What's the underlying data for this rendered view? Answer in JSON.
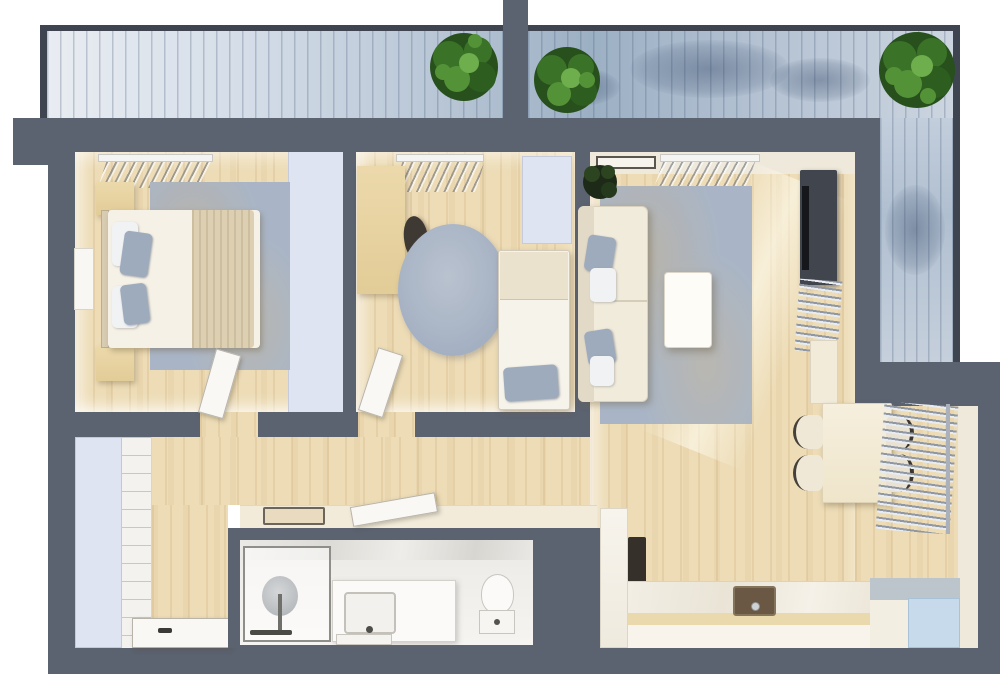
{
  "scene": {
    "kind": "3d-rendered-apartment-floor-plan-top-view",
    "has_text": false,
    "balcony": {
      "position": "top-and-right-l-shape",
      "trees": 3,
      "privacy_divider": true
    },
    "rooms": [
      {
        "name": "bedroom-1",
        "furniture": [
          "double-bed",
          "beige-blanket",
          "grey-pillows",
          "nightstand-top",
          "nightstand-bottom",
          "area-rug",
          "wall-picture-frame",
          "built-in-wardrobe",
          "window-blinds",
          "open-door"
        ]
      },
      {
        "name": "bedroom-2",
        "furniture": [
          "desk",
          "desk-chair",
          "round-rug",
          "wardrobe",
          "single-bed",
          "grey-pillow",
          "window-blinds",
          "open-door"
        ]
      },
      {
        "name": "living-room",
        "furniture": [
          "sofa",
          "throw-pillows",
          "coffee-table",
          "area-rug",
          "potted-plant",
          "wall-art",
          "window-blinds",
          "tv-console",
          "tv",
          "towel-radiator",
          "tall-cabinet-pillar"
        ]
      },
      {
        "name": "dining-area",
        "furniture": [
          "dining-table",
          "chair-left-1",
          "chair-left-2",
          "chair-right-1",
          "chair-right-2",
          "wall-radiator"
        ]
      },
      {
        "name": "kitchen",
        "furniture": [
          "tall-cabinet",
          "oven",
          "l-shaped-counter",
          "sink",
          "faucet",
          "fridge"
        ]
      },
      {
        "name": "bathroom",
        "furniture": [
          "walk-in-shower",
          "rain-shower-head",
          "vanity-sink",
          "bath-mat",
          "toilet",
          "open-door",
          "console-shelf",
          "tray"
        ]
      },
      {
        "name": "hallway-entry",
        "furniture": [
          "closet",
          "panelled-cabinet",
          "entrance-door"
        ]
      }
    ]
  },
  "palette": {
    "wall": "#5b6270",
    "wallEdge": "#3e4450",
    "wood": "#eddcb6",
    "cream": "#f2ebda",
    "creamFace": "#efe9db",
    "white": "#f8f7f4",
    "rugBlue": "#a9b5c6",
    "pillowGrey": "#9dabbd",
    "wardrobeBlue": "#dee4f1",
    "fridgeBlue": "#c6daeb",
    "counterGrey": "#bcc4cc",
    "sinkBrown": "#6a5844",
    "tvDark": "#40454e",
    "chairDark": "#3e3a33",
    "treeGreen1": "#27501c",
    "treeGreen2": "#3a7327",
    "treeGreen3": "#549238",
    "treeGreen4": "#6fae4d"
  }
}
